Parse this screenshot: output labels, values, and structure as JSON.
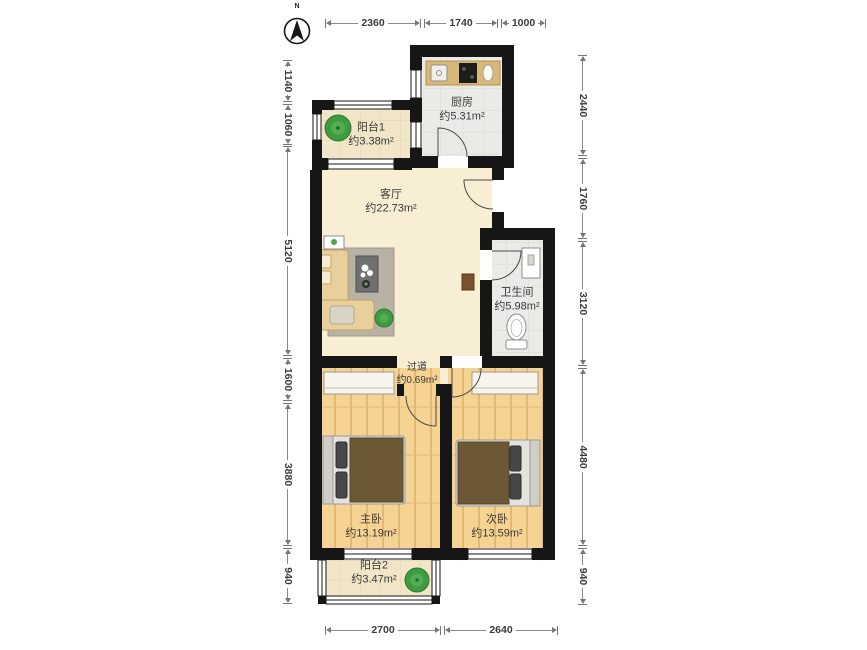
{
  "compass": {
    "label": "N"
  },
  "dims": {
    "top": [
      "2360",
      "1740",
      "1000"
    ],
    "bottom": [
      "2700",
      "2640"
    ],
    "left": [
      "1140",
      "1060",
      "5120",
      "1600",
      "3880",
      "940"
    ],
    "right": [
      "2440",
      "1760",
      "3120",
      "4480",
      "940"
    ]
  },
  "rooms": {
    "kitchen": {
      "name": "厨房",
      "area": "约5.31m²"
    },
    "balcony1": {
      "name": "阳台1",
      "area": "约3.38m²"
    },
    "living": {
      "name": "客厅",
      "area": "约22.73m²"
    },
    "bathroom": {
      "name": "卫生间",
      "area": "约5.98m²"
    },
    "hallway": {
      "name": "过道",
      "area": "约0.69m²"
    },
    "master": {
      "name": "主卧",
      "area": "约13.19m²"
    },
    "second": {
      "name": "次卧",
      "area": "约13.59m²"
    },
    "balcony2": {
      "name": "阳台2",
      "area": "约3.47m²"
    }
  },
  "colors": {
    "wall": "#161616",
    "wood_floor": "#f5d392",
    "tile_floor": "#eaeae6",
    "living_floor": "#f8eed3",
    "balcony_floor": "#f2e6c8",
    "counter": "#d8b878",
    "bed_blanket": "#6d5835",
    "sofa": "#e8cf9c",
    "rug": "#b7b2a4",
    "plant": "#3e9b41"
  }
}
